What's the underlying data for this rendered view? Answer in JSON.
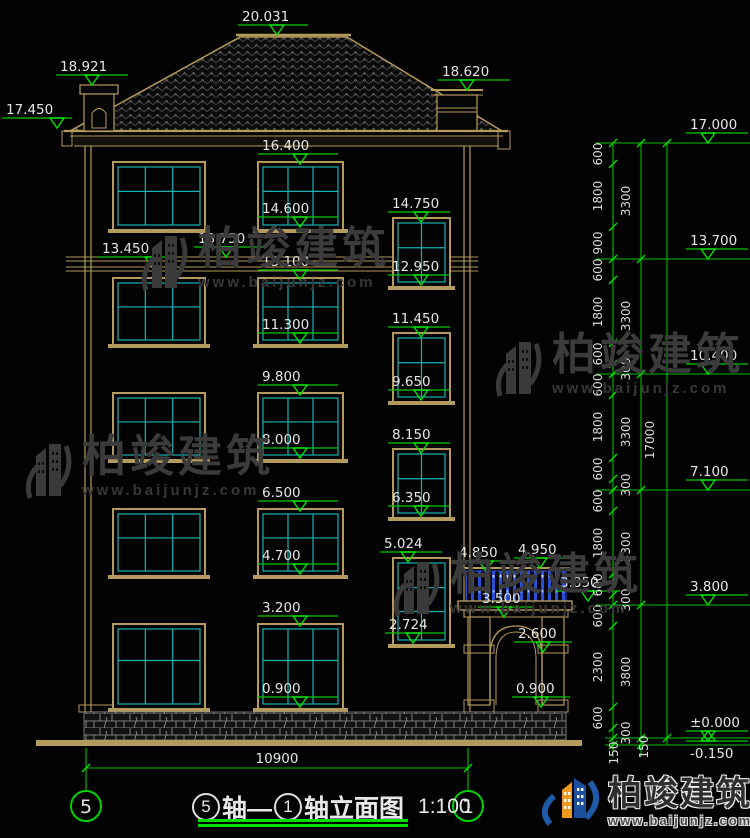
{
  "drawing_title": {
    "axis_start": "5",
    "axis_start_suffix": "轴—",
    "axis_end": "1",
    "axis_end_suffix": "轴立面图",
    "scale": "1:100"
  },
  "axis_bubbles": {
    "left": "5",
    "right": "1"
  },
  "bottom_dimension": "10900",
  "watermark": {
    "text": "柏竣建筑",
    "url": "www.baijunjz.com"
  },
  "brand": {
    "text": "柏竣建筑",
    "url": "www.baijunjz.com"
  },
  "colors": {
    "dim_green": "#00c000",
    "bright_green": "#00e400",
    "text_white": "#e6e6e6",
    "frame_tan": "#b49a5c",
    "glass_cyan": "#17b3b3",
    "rail_blue": "#2b4fd0"
  },
  "level_markers": [
    {
      "label": "20.031",
      "lx": 238,
      "ly": 25,
      "lw": 70,
      "tx": 277,
      "dir": 1
    },
    {
      "label": "18.921",
      "lx": 56,
      "ly": 75,
      "lw": 72,
      "tx": 92,
      "dir": 1
    },
    {
      "label": "17.450",
      "lx": 2,
      "ly": 118,
      "lw": 70,
      "tx": 57,
      "dir": 1
    },
    {
      "label": "18.620",
      "lx": 438,
      "ly": 80,
      "lw": 72,
      "tx": 467,
      "dir": 1
    },
    {
      "label": "16.400",
      "lx": 258,
      "ly": 154,
      "lw": 80,
      "tx": 300,
      "dir": 1
    },
    {
      "label": "14.600",
      "lx": 258,
      "ly": 217,
      "lw": 80,
      "tx": 300,
      "dir": 1
    },
    {
      "label": "14.750",
      "lx": 388,
      "ly": 212,
      "lw": 62,
      "tx": 421,
      "dir": 1
    },
    {
      "label": "13.450",
      "lx": 98,
      "ly": 257,
      "lw": 72,
      "tx": 152,
      "dir": 1
    },
    {
      "label": "13.750",
      "lx": 194,
      "ly": 247,
      "lw": 72,
      "tx": 226,
      "dir": 1
    },
    {
      "label": "13.100",
      "lx": 258,
      "ly": 270,
      "lw": 80,
      "tx": 300,
      "dir": 1
    },
    {
      "label": "12.950",
      "lx": 388,
      "ly": 275,
      "lw": 62,
      "tx": 421,
      "dir": 1
    },
    {
      "label": "11.300",
      "lx": 258,
      "ly": 333,
      "lw": 80,
      "tx": 300,
      "dir": 1
    },
    {
      "label": "11.450",
      "lx": 388,
      "ly": 327,
      "lw": 62,
      "tx": 421,
      "dir": 1
    },
    {
      "label": "9.800",
      "lx": 258,
      "ly": 385,
      "lw": 80,
      "tx": 300,
      "dir": 1
    },
    {
      "label": "9.650",
      "lx": 388,
      "ly": 390,
      "lw": 62,
      "tx": 421,
      "dir": 1
    },
    {
      "label": "8.000",
      "lx": 258,
      "ly": 448,
      "lw": 80,
      "tx": 300,
      "dir": 1
    },
    {
      "label": "8.150",
      "lx": 388,
      "ly": 443,
      "lw": 62,
      "tx": 421,
      "dir": 1
    },
    {
      "label": "6.500",
      "lx": 258,
      "ly": 501,
      "lw": 80,
      "tx": 300,
      "dir": 1
    },
    {
      "label": "6.350",
      "lx": 388,
      "ly": 506,
      "lw": 62,
      "tx": 421,
      "dir": 1
    },
    {
      "label": "4.700",
      "lx": 258,
      "ly": 564,
      "lw": 80,
      "tx": 300,
      "dir": 1
    },
    {
      "label": "5.024",
      "lx": 380,
      "ly": 552,
      "lw": 62,
      "tx": 408,
      "dir": 1
    },
    {
      "label": "4.850",
      "lx": 455,
      "ly": 561,
      "lw": 56,
      "tx": 486,
      "dir": 1
    },
    {
      "label": "4.950",
      "lx": 514,
      "ly": 558,
      "lw": 56,
      "tx": 540,
      "dir": 1
    },
    {
      "label": "3.850",
      "lx": 556,
      "ly": 591,
      "lw": 64,
      "tx": 588,
      "dir": 1
    },
    {
      "label": "3.500",
      "lx": 478,
      "ly": 607,
      "lw": 54,
      "tx": 504,
      "dir": 1
    },
    {
      "label": "2.600",
      "lx": 514,
      "ly": 642,
      "lw": 58,
      "tx": 543,
      "dir": 1
    },
    {
      "label": "3.200",
      "lx": 258,
      "ly": 616,
      "lw": 80,
      "tx": 300,
      "dir": 1
    },
    {
      "label": "2.724",
      "lx": 385,
      "ly": 633,
      "lw": 60,
      "tx": 413,
      "dir": 1
    },
    {
      "label": "0.900",
      "lx": 258,
      "ly": 697,
      "lw": 80,
      "tx": 300,
      "dir": 1
    },
    {
      "label": "0.900",
      "lx": 512,
      "ly": 697,
      "lw": 58,
      "tx": 541,
      "dir": 1
    },
    {
      "label": "17.000",
      "lx": 686,
      "ly": 133,
      "lw": 62,
      "tx": 708,
      "dir": 1
    },
    {
      "label": "13.700",
      "lx": 686,
      "ly": 249,
      "lw": 62,
      "tx": 708,
      "dir": 1
    },
    {
      "label": "10.400",
      "lx": 686,
      "ly": 364,
      "lw": 62,
      "tx": 708,
      "dir": 1
    },
    {
      "label": "7.100",
      "lx": 686,
      "ly": 480,
      "lw": 62,
      "tx": 708,
      "dir": 1
    },
    {
      "label": "3.800",
      "lx": 686,
      "ly": 595,
      "lw": 62,
      "tx": 708,
      "dir": 1
    },
    {
      "label": "±0.000",
      "lx": 686,
      "ly": 731,
      "lw": 62,
      "tx": 708,
      "dir": 1
    },
    {
      "label": "-0.150",
      "lx": 686,
      "ly": 741,
      "lw": 62,
      "tx": 708,
      "dir": -1
    }
  ],
  "dim_labels": [
    {
      "t": "600",
      "x": 602,
      "y": 154
    },
    {
      "t": "1800",
      "x": 602,
      "y": 196
    },
    {
      "t": "900",
      "x": 602,
      "y": 243
    },
    {
      "t": "600",
      "x": 602,
      "y": 270
    },
    {
      "t": "1800",
      "x": 602,
      "y": 312
    },
    {
      "t": "600",
      "x": 602,
      "y": 354
    },
    {
      "t": "600",
      "x": 602,
      "y": 385
    },
    {
      "t": "1800",
      "x": 602,
      "y": 427
    },
    {
      "t": "600",
      "x": 602,
      "y": 469
    },
    {
      "t": "600",
      "x": 602,
      "y": 501
    },
    {
      "t": "1800",
      "x": 602,
      "y": 543
    },
    {
      "t": "600",
      "x": 602,
      "y": 585
    },
    {
      "t": "600",
      "x": 602,
      "y": 616
    },
    {
      "t": "2300",
      "x": 602,
      "y": 667
    },
    {
      "t": "600",
      "x": 602,
      "y": 718
    },
    {
      "t": "150",
      "x": 618,
      "y": 753
    },
    {
      "t": "3300",
      "x": 630,
      "y": 201
    },
    {
      "t": "3300",
      "x": 630,
      "y": 316
    },
    {
      "t": "300",
      "x": 630,
      "y": 369
    },
    {
      "t": "3300",
      "x": 630,
      "y": 432
    },
    {
      "t": "300",
      "x": 630,
      "y": 485
    },
    {
      "t": "3300",
      "x": 630,
      "y": 547
    },
    {
      "t": "300",
      "x": 630,
      "y": 600
    },
    {
      "t": "3800",
      "x": 630,
      "y": 672
    },
    {
      "t": "300",
      "x": 630,
      "y": 733
    },
    {
      "t": "150",
      "x": 648,
      "y": 747
    },
    {
      "t": "17000",
      "x": 654,
      "y": 440
    }
  ],
  "watermark_positions": [
    {
      "left": 138,
      "top": 226
    },
    {
      "left": 492,
      "top": 332
    },
    {
      "left": 22,
      "top": 434
    },
    {
      "left": 390,
      "top": 552
    }
  ]
}
